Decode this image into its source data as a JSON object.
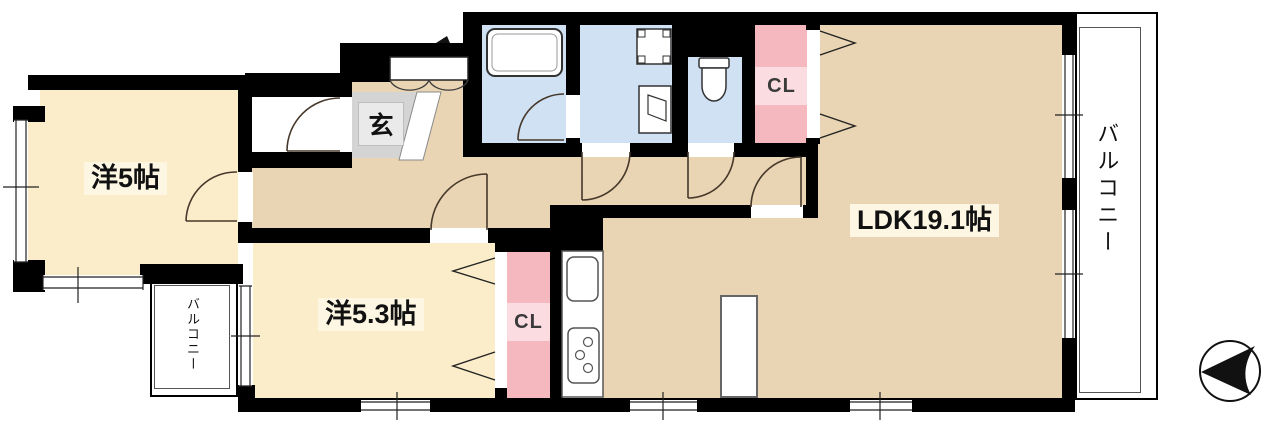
{
  "title": "apartment-floor-plan",
  "colors": {
    "wall": "#000000",
    "room_cream": "#fcedca",
    "room_tan": "#e9d5b3",
    "room_wet": "#cfe1f2",
    "closet_pink": "#f6b8bf",
    "closet_pink_light": "#fbdce0",
    "genkan_gray": "#d4d4d4",
    "genkan_box": "#eaeaea",
    "label_bg": "#fdf6e3",
    "door_line": "#46382b",
    "fixture_line": "#3c3c3c"
  },
  "rooms": {
    "western_5": {
      "label": "洋5帖"
    },
    "western_5_3": {
      "label": "洋5.3帖"
    },
    "ldk": {
      "label": "LDK19.1帖"
    },
    "entrance": {
      "label": "玄"
    },
    "closet_hall": {
      "label": "CL"
    },
    "closet_bedroom": {
      "label": "CL"
    },
    "balcony_right": {
      "label": "バルコニー"
    },
    "balcony_left": {
      "label": "バルコニー"
    }
  },
  "icons": {
    "north_arrow": "compass-arrow-pointing-left",
    "bathtub": "bathtub-symbol",
    "washer": "washing-machine-symbol",
    "washbasin": "washbasin-symbol",
    "toilet": "toilet-symbol",
    "kitchen": "sink-and-stove-symbol"
  }
}
